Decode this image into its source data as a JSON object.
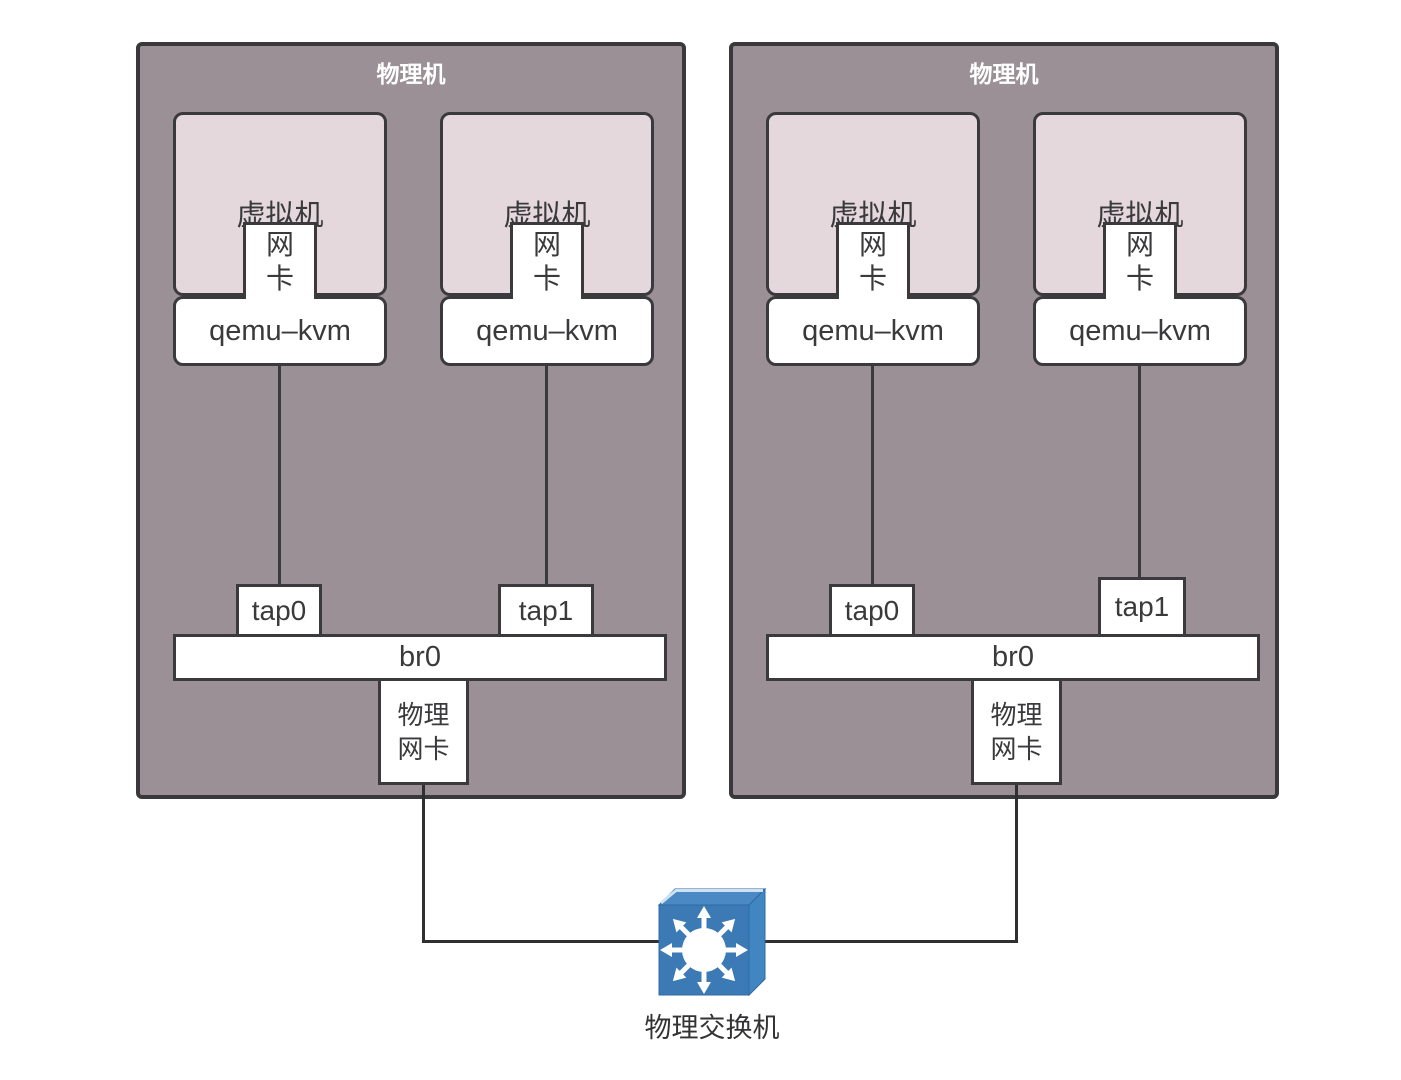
{
  "machines": [
    {
      "title": "物理机",
      "columns": [
        {
          "vm_label": "虚拟机",
          "nic": [
            "网",
            "卡"
          ],
          "hypervisor": "qemu–kvm",
          "tap": "tap0"
        },
        {
          "vm_label": "虚拟机",
          "nic": [
            "网",
            "卡"
          ],
          "hypervisor": "qemu–kvm",
          "tap": "tap1"
        }
      ],
      "bridge": "br0",
      "physical_nic": [
        "物理",
        "网卡"
      ]
    },
    {
      "title": "物理机",
      "columns": [
        {
          "vm_label": "虚拟机",
          "nic": [
            "网",
            "卡"
          ],
          "hypervisor": "qemu–kvm",
          "tap": "tap0"
        },
        {
          "vm_label": "虚拟机",
          "nic": [
            "网",
            "卡"
          ],
          "hypervisor": "qemu–kvm",
          "tap": "tap1"
        }
      ],
      "bridge": "br0",
      "physical_nic": [
        "物理",
        "网卡"
      ]
    }
  ],
  "switch": {
    "label": "物理交换机"
  },
  "colors": {
    "machine_fill": "#9a9095",
    "machine_border": "#39393b",
    "vm_fill": "#e5d8dc",
    "box_border": "#3a3a3c",
    "wire": "#2f2f31",
    "title_text": "#ffffff",
    "switch_front": "#3c7ab6",
    "switch_top": "#4a89c4",
    "switch_side": "#4286c1"
  }
}
